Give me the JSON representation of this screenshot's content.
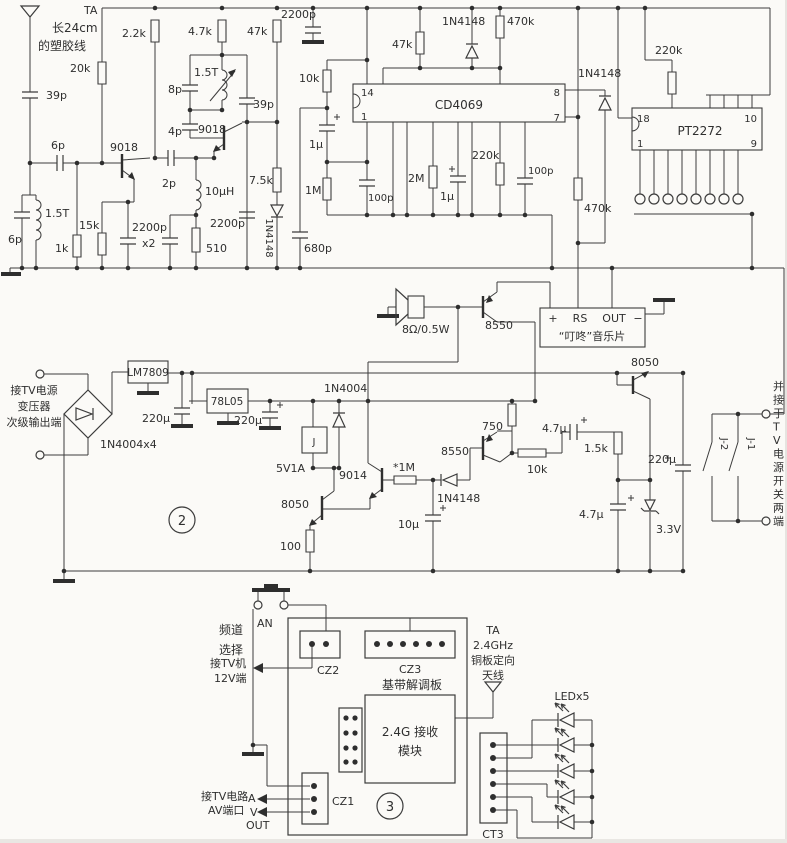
{
  "figure": {
    "kind": "circuit-schematic",
    "width": 787,
    "height": 843,
    "ink": "#3c3c3c",
    "bg": "#fbfaf7",
    "section_markers": [
      "2",
      "3"
    ]
  },
  "schematic": {
    "ics": [
      "CD4069",
      "PT2272",
      "LM7809",
      "78L05"
    ],
    "labels": [
      {
        "id": "ta1",
        "text": "TA",
        "x": 84,
        "y": 14,
        "a": "start",
        "s": 11
      },
      {
        "id": "ant-note1",
        "text": "长24cm",
        "x": 52,
        "y": 32,
        "a": "start",
        "s": 12
      },
      {
        "id": "ant-note2",
        "text": "的塑胶线",
        "x": 38,
        "y": 50,
        "a": "start",
        "s": 12
      },
      {
        "id": "c39p1",
        "text": "39p",
        "x": 46,
        "y": 99,
        "a": "start",
        "s": 11
      },
      {
        "id": "c6p1",
        "text": "6p",
        "x": 51,
        "y": 149,
        "a": "start",
        "s": 11
      },
      {
        "id": "l3",
        "text": "1.5T",
        "x": 45,
        "y": 217,
        "a": "start",
        "s": 11
      },
      {
        "id": "c6p2",
        "text": "6p",
        "x": 8,
        "y": 243,
        "a": "start",
        "s": 11
      },
      {
        "id": "r1k",
        "text": "1k",
        "x": 55,
        "y": 252,
        "a": "start",
        "s": 11
      },
      {
        "id": "r15k",
        "text": "15k",
        "x": 79,
        "y": 229,
        "a": "start",
        "s": 11
      },
      {
        "id": "q1",
        "text": "9018",
        "x": 110,
        "y": 151,
        "a": "start",
        "s": 11
      },
      {
        "id": "c2p",
        "text": "2p",
        "x": 162,
        "y": 187,
        "a": "start",
        "s": 11
      },
      {
        "id": "c2200pa",
        "text": "2200p",
        "x": 132,
        "y": 231,
        "a": "start",
        "s": 11
      },
      {
        "id": "c2200pb",
        "text": "x2",
        "x": 142,
        "y": 247,
        "a": "start",
        "s": 11
      },
      {
        "id": "r510",
        "text": "510",
        "x": 206,
        "y": 252,
        "a": "start",
        "s": 11
      },
      {
        "id": "l2",
        "text": "10µH",
        "x": 205,
        "y": 195,
        "a": "start",
        "s": 11
      },
      {
        "id": "r20k",
        "text": "20k",
        "x": 70,
        "y": 72,
        "a": "start",
        "s": 11
      },
      {
        "id": "r2k2",
        "text": "2.2k",
        "x": 122,
        "y": 37,
        "a": "start",
        "s": 11
      },
      {
        "id": "r4k7",
        "text": "4.7k",
        "x": 188,
        "y": 35,
        "a": "start",
        "s": 11
      },
      {
        "id": "c8p",
        "text": "8p",
        "x": 168,
        "y": 93,
        "a": "start",
        "s": 11
      },
      {
        "id": "l1",
        "text": "1.5T",
        "x": 194,
        "y": 76,
        "a": "start",
        "s": 11
      },
      {
        "id": "c4p",
        "text": "4p",
        "x": 168,
        "y": 135,
        "a": "start",
        "s": 11
      },
      {
        "id": "q2",
        "text": "9018",
        "x": 198,
        "y": 133,
        "a": "start",
        "s": 11
      },
      {
        "id": "c39p2",
        "text": "39p",
        "x": 253,
        "y": 108,
        "a": "start",
        "s": 11
      },
      {
        "id": "r47k1",
        "text": "47k",
        "x": 247,
        "y": 35,
        "a": "start",
        "s": 11
      },
      {
        "id": "r7k5",
        "text": "7.5k",
        "x": 249,
        "y": 184,
        "a": "start",
        "s": 11
      },
      {
        "id": "d3",
        "text": "1N4148",
        "x": 266,
        "y": 238,
        "a": "middle",
        "s": 10,
        "rot": 90
      },
      {
        "id": "c2200p4",
        "text": "2200p",
        "x": 210,
        "y": 227,
        "a": "start",
        "s": 11
      },
      {
        "id": "c2200p5",
        "text": "2200p",
        "x": 281,
        "y": 18,
        "a": "start",
        "s": 11
      },
      {
        "id": "r10k1",
        "text": "10k",
        "x": 299,
        "y": 82,
        "a": "start",
        "s": 11
      },
      {
        "id": "c1u1",
        "text": "1µ",
        "x": 309,
        "y": 148,
        "a": "start",
        "s": 11
      },
      {
        "id": "r1m1",
        "text": "1M",
        "x": 305,
        "y": 194,
        "a": "start",
        "s": 11
      },
      {
        "id": "c680p",
        "text": "680p",
        "x": 304,
        "y": 252,
        "a": "start",
        "s": 11
      },
      {
        "id": "c100p1",
        "text": "100p",
        "x": 368,
        "y": 201,
        "a": "start",
        "s": 10
      },
      {
        "id": "r2m",
        "text": "2M",
        "x": 408,
        "y": 182,
        "a": "start",
        "s": 11
      },
      {
        "id": "c1u2",
        "text": "1µ",
        "x": 440,
        "y": 200,
        "a": "start",
        "s": 11
      },
      {
        "id": "r220k1",
        "text": "220k",
        "x": 472,
        "y": 159,
        "a": "start",
        "s": 11
      },
      {
        "id": "c100p2",
        "text": "100p",
        "x": 528,
        "y": 174,
        "a": "start",
        "s": 10
      },
      {
        "id": "r47k2",
        "text": "47k",
        "x": 392,
        "y": 48,
        "a": "start",
        "s": 11
      },
      {
        "id": "d1",
        "text": "1N4148",
        "x": 442,
        "y": 25,
        "a": "start",
        "s": 11
      },
      {
        "id": "r470k1",
        "text": "470k",
        "x": 507,
        "y": 25,
        "a": "start",
        "s": 11
      },
      {
        "id": "u1",
        "text": "CD4069",
        "x": 459,
        "y": 109,
        "a": "middle",
        "s": 12
      },
      {
        "id": "u1p14",
        "text": "14",
        "x": 361,
        "y": 96,
        "a": "start",
        "s": 10
      },
      {
        "id": "u1p1",
        "text": "1",
        "x": 361,
        "y": 120,
        "a": "start",
        "s": 10
      },
      {
        "id": "u1p8",
        "text": "8",
        "x": 560,
        "y": 96,
        "a": "end",
        "s": 10
      },
      {
        "id": "u1p7",
        "text": "7",
        "x": 560,
        "y": 121,
        "a": "end",
        "s": 10
      },
      {
        "id": "r470k2",
        "text": "470k",
        "x": 584,
        "y": 212,
        "a": "start",
        "s": 11
      },
      {
        "id": "d2",
        "text": "1N4148",
        "x": 578,
        "y": 77,
        "a": "start",
        "s": 11
      },
      {
        "id": "r220k2",
        "text": "220k",
        "x": 655,
        "y": 54,
        "a": "start",
        "s": 11
      },
      {
        "id": "u2",
        "text": "PT2272",
        "x": 700,
        "y": 135,
        "a": "middle",
        "s": 12
      },
      {
        "id": "u2p18",
        "text": "18",
        "x": 637,
        "y": 122,
        "a": "start",
        "s": 10
      },
      {
        "id": "u2p1",
        "text": "1",
        "x": 637,
        "y": 147,
        "a": "start",
        "s": 10
      },
      {
        "id": "u2p10",
        "text": "10",
        "x": 757,
        "y": 122,
        "a": "end",
        "s": 10
      },
      {
        "id": "u2p9",
        "text": "9",
        "x": 757,
        "y": 147,
        "a": "end",
        "s": 10
      },
      {
        "id": "spk",
        "text": "8Ω/0.5W",
        "x": 402,
        "y": 333,
        "a": "start",
        "s": 11
      },
      {
        "id": "q3",
        "text": "8550",
        "x": 485,
        "y": 329,
        "a": "start",
        "s": 11
      },
      {
        "id": "chip-plus",
        "text": "+",
        "x": 553,
        "y": 322,
        "a": "middle",
        "s": 11
      },
      {
        "id": "chip-rs",
        "text": "RS",
        "x": 580,
        "y": 322,
        "a": "middle",
        "s": 11
      },
      {
        "id": "chip-out",
        "text": "OUT",
        "x": 614,
        "y": 322,
        "a": "middle",
        "s": 11
      },
      {
        "id": "chip-minus",
        "text": "−",
        "x": 638,
        "y": 322,
        "a": "middle",
        "s": 11
      },
      {
        "id": "chip-name",
        "text": "“叮咚”音乐片",
        "x": 592,
        "y": 340,
        "a": "middle",
        "s": 11
      },
      {
        "id": "q4",
        "text": "8050",
        "x": 631,
        "y": 366,
        "a": "start",
        "s": 11
      },
      {
        "id": "pwr1",
        "text": "接TV电源",
        "x": 34,
        "y": 394,
        "a": "middle",
        "s": 11
      },
      {
        "id": "pwr2",
        "text": "变压器",
        "x": 34,
        "y": 410,
        "a": "middle",
        "s": 11
      },
      {
        "id": "pwr3",
        "text": "次级输出端",
        "x": 34,
        "y": 426,
        "a": "middle",
        "s": 11
      },
      {
        "id": "bridge",
        "text": "1N4004x4",
        "x": 100,
        "y": 448,
        "a": "start",
        "s": 11
      },
      {
        "id": "u3",
        "text": "LM7809",
        "x": 148,
        "y": 376,
        "a": "middle",
        "s": 10.5
      },
      {
        "id": "c220u1",
        "text": "220µ",
        "x": 142,
        "y": 422,
        "a": "start",
        "s": 11
      },
      {
        "id": "u4",
        "text": "78L05",
        "x": 227,
        "y": 405,
        "a": "middle",
        "s": 10.5
      },
      {
        "id": "c220u2",
        "text": "220µ",
        "x": 234,
        "y": 424,
        "a": "start",
        "s": 11
      },
      {
        "id": "d4",
        "text": "1N4004",
        "x": 324,
        "y": 392,
        "a": "start",
        "s": 11
      },
      {
        "id": "relay",
        "text": "J",
        "x": 314,
        "y": 445,
        "a": "middle",
        "s": 10
      },
      {
        "id": "relay-v",
        "text": "5V1A",
        "x": 276,
        "y": 472,
        "a": "start",
        "s": 11
      },
      {
        "id": "q5",
        "text": "8050",
        "x": 281,
        "y": 508,
        "a": "start",
        "s": 11
      },
      {
        "id": "r100",
        "text": "100",
        "x": 280,
        "y": 550,
        "a": "start",
        "s": 11
      },
      {
        "id": "q6",
        "text": "9014",
        "x": 339,
        "y": 479,
        "a": "start",
        "s": 11
      },
      {
        "id": "r1m2",
        "text": "*1M",
        "x": 393,
        "y": 471,
        "a": "start",
        "s": 11
      },
      {
        "id": "d5",
        "text": "1N4148",
        "x": 437,
        "y": 502,
        "a": "start",
        "s": 11
      },
      {
        "id": "c10u",
        "text": "10µ",
        "x": 398,
        "y": 528,
        "a": "start",
        "s": 11
      },
      {
        "id": "q7",
        "text": "8550",
        "x": 441,
        "y": 455,
        "a": "start",
        "s": 11
      },
      {
        "id": "r750",
        "text": "750",
        "x": 482,
        "y": 430,
        "a": "start",
        "s": 11
      },
      {
        "id": "r10k2",
        "text": "10k",
        "x": 527,
        "y": 473,
        "a": "start",
        "s": 11
      },
      {
        "id": "c47u1",
        "text": "4.7µ",
        "x": 542,
        "y": 432,
        "a": "start",
        "s": 11
      },
      {
        "id": "r1k5",
        "text": "1.5k",
        "x": 584,
        "y": 452,
        "a": "start",
        "s": 11
      },
      {
        "id": "c220u3",
        "text": "220µ",
        "x": 648,
        "y": 463,
        "a": "start",
        "s": 11
      },
      {
        "id": "c47u2",
        "text": "4.7µ",
        "x": 579,
        "y": 518,
        "a": "start",
        "s": 11
      },
      {
        "id": "dz",
        "text": "3.3V",
        "x": 656,
        "y": 533,
        "a": "start",
        "s": 11
      },
      {
        "id": "mark2",
        "text": "2",
        "x": 182,
        "y": 525,
        "a": "middle",
        "s": 13
      },
      {
        "id": "j2",
        "text": "J-2",
        "x": 721,
        "y": 444,
        "a": "middle",
        "s": 10,
        "rot": 90
      },
      {
        "id": "j1",
        "text": "J-1",
        "x": 748,
        "y": 444,
        "a": "middle",
        "s": 10,
        "rot": 90
      },
      {
        "id": "side-note",
        "text": "并接于TV电源开关两端",
        "x": 773,
        "y": 390,
        "a": "start",
        "s": 11,
        "vert": true
      },
      {
        "id": "ch1",
        "text": "频道",
        "x": 219,
        "y": 634,
        "a": "start",
        "s": 12
      },
      {
        "id": "ch2",
        "text": "选择",
        "x": 219,
        "y": 654,
        "a": "start",
        "s": 12
      },
      {
        "id": "an",
        "text": "AN",
        "x": 257,
        "y": 627,
        "a": "start",
        "s": 11
      },
      {
        "id": "tv12a",
        "text": "接TV机",
        "x": 210,
        "y": 667,
        "a": "start",
        "s": 11
      },
      {
        "id": "tv12b",
        "text": "12V端",
        "x": 214,
        "y": 682,
        "a": "start",
        "s": 11
      },
      {
        "id": "cz2",
        "text": "CZ2",
        "x": 317,
        "y": 674,
        "a": "start",
        "s": 11
      },
      {
        "id": "cz3",
        "text": "CZ3",
        "x": 399,
        "y": 673,
        "a": "start",
        "s": 11
      },
      {
        "id": "bb",
        "text": "基带解调板",
        "x": 412,
        "y": 689,
        "a": "middle",
        "s": 12
      },
      {
        "id": "mod1",
        "text": "2.4G 接收",
        "x": 410,
        "y": 736,
        "a": "middle",
        "s": 12
      },
      {
        "id": "mod2",
        "text": "模块",
        "x": 410,
        "y": 755,
        "a": "middle",
        "s": 12
      },
      {
        "id": "ta2a",
        "text": "TA",
        "x": 493,
        "y": 634,
        "a": "middle",
        "s": 11
      },
      {
        "id": "ta2b",
        "text": "2.4GHz",
        "x": 493,
        "y": 649,
        "a": "middle",
        "s": 11
      },
      {
        "id": "ta2c",
        "text": "铜板定向",
        "x": 493,
        "y": 664,
        "a": "middle",
        "s": 11
      },
      {
        "id": "ta2d",
        "text": "天线",
        "x": 493,
        "y": 679,
        "a": "middle",
        "s": 11
      },
      {
        "id": "led",
        "text": "LEDx5",
        "x": 572,
        "y": 700,
        "a": "middle",
        "s": 11
      },
      {
        "id": "cz1",
        "text": "CZ1",
        "x": 332,
        "y": 805,
        "a": "start",
        "s": 11
      },
      {
        "id": "av1",
        "text": "接TV电路",
        "x": 201,
        "y": 800,
        "a": "start",
        "s": 11
      },
      {
        "id": "avA",
        "text": "A",
        "x": 248,
        "y": 802,
        "a": "start",
        "s": 11
      },
      {
        "id": "av2",
        "text": "AV端口",
        "x": 208,
        "y": 814,
        "a": "start",
        "s": 11
      },
      {
        "id": "avV",
        "text": "V",
        "x": 250,
        "y": 816,
        "a": "start",
        "s": 11
      },
      {
        "id": "avOut",
        "text": "OUT",
        "x": 246,
        "y": 829,
        "a": "start",
        "s": 11
      },
      {
        "id": "ct3",
        "text": "CT3",
        "x": 493,
        "y": 838,
        "a": "middle",
        "s": 11
      },
      {
        "id": "mark3",
        "text": "3",
        "x": 390,
        "y": 811,
        "a": "middle",
        "s": 13
      }
    ]
  }
}
